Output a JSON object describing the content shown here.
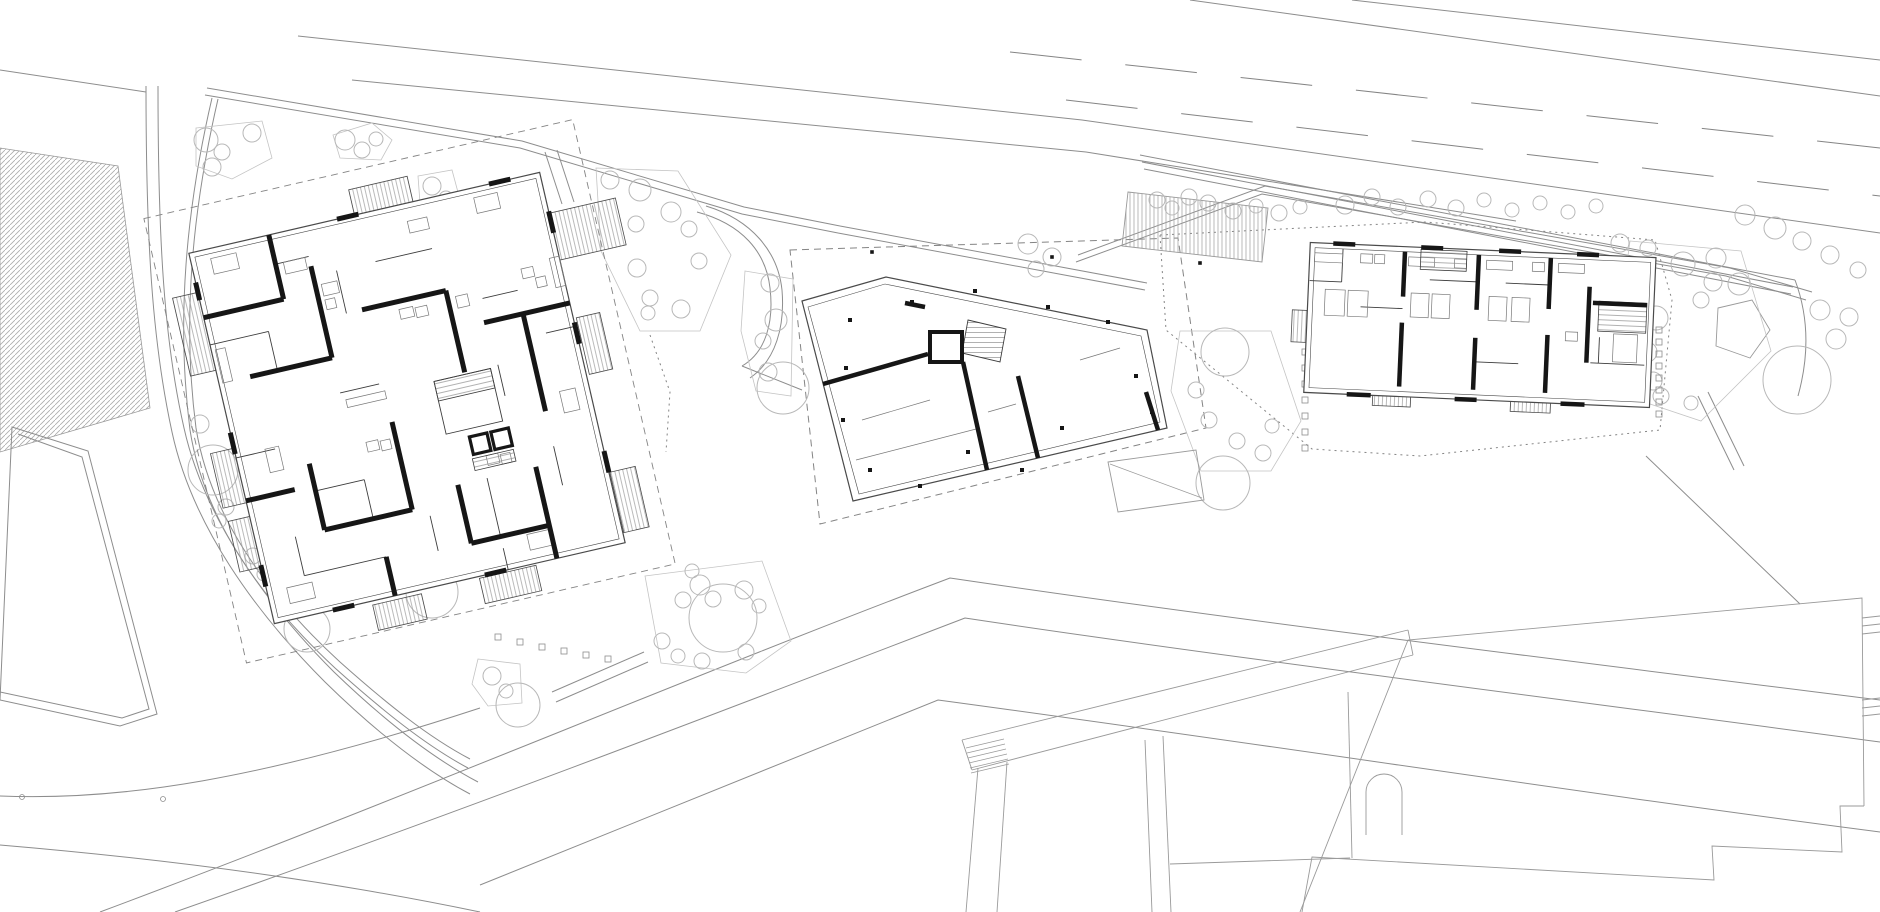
{
  "meta": {
    "type": "architectural-site-plan",
    "canvas": {
      "w": 1880,
      "h": 912
    }
  },
  "palette": {
    "bg": "#ffffff",
    "ink": "#161616",
    "wall_thin": "#3c3c3c",
    "outline": "#4a4a4a",
    "context": "#8d8d8d",
    "faint": "#9a9a9a",
    "tree": "#b8b8b8",
    "cluster": "#c4c4c4",
    "furniture": "#787878",
    "dash": "#848484",
    "hatch": "#a6a6a6"
  },
  "context": {
    "hatch_field": "0,148 118,166 150,408 0,452",
    "lines": [
      "M0,70 L146,92",
      "M298,36 L1082,120 L1880,233",
      "M352,80 L1086,152 L1516,221",
      "M1190,0 L1880,96",
      "M1352,0 L1880,60",
      "M146,86 C146,240 152,340 172,432 C192,525 255,612 325,682 C378,734 428,772 470,794",
      "M158,86 C158,240 164,340 184,428 C204,518 266,604 334,672 C388,724 436,760 478,782",
      "M212,98 C186,210 176,320 190,430 C204,520 262,600 335,668 C382,710 425,745 468,768",
      "M218,99 C192,212 182,320 196,428 C210,516 268,596 340,662 C386,703 428,737 470,759",
      "M100,912 C400,800 680,680 950,578 C1220,618 1560,660 1880,700",
      "M175,912 C460,812 720,712 965,618 C1230,658 1570,700 1880,742",
      "M480,885 C700,795 850,735 938,700 C1250,742 1600,796 1880,832",
      "M0,796 C120,801 260,780 480,708",
      "M0,845 C200,862 350,885 480,912",
      "M556,702 L648,662",
      "M552,692 L644,652",
      "M205,95 L520,148 L742,214 L838,233",
      "M207,88 L522,141 L744,207 L840,226",
      "M840,226 L1147,283",
      "M838,233 L1145,290",
      "M1078,255 L1265,186 L1730,268 L1812,292",
      "M1076,262 L1262,194 L1726,276 L1806,300",
      "M1140,155 L1795,280",
      "M1142,162 L1793,287",
      "M1144,169 L1791,294",
      "M1795,280 C1810,320 1808,360 1798,396",
      "M545,152 L562,204",
      "M557,150 L574,202",
      "M697,212 C742,224 766,252 770,288 C774,322 766,352 742,366",
      "M706,206 C752,220 778,252 782,290 C785,326 776,360 750,378",
      "M742,366 L802,390",
      "M1698,396 L1734,470",
      "M1708,392 L1744,466",
      "M1646,456 L1800,604"
    ],
    "dashed_lines": [
      {
        "d": "M1010,52 L1880,148",
        "dash": "72 44"
      },
      {
        "d": "M1066,100 L1880,196",
        "dash": "72 44"
      },
      {
        "d": "M790,250 L1178,238 L1206,428 L820,524 Z",
        "dash": "7 5"
      },
      {
        "d": "M1160,235 L1425,222 L1655,240 L1672,300 L1660,430 L1420,456 L1312,449 L1166,330 Z",
        "dash": "2 4"
      },
      {
        "d": "M650,335 L670,392 L666,452",
        "dash": "2 4"
      }
    ],
    "parcel": [
      "M12,427 L88,451 L157,714 L120,726 L0,700 Z",
      "M18,434 L82,457 L149,709 L122,718 L0,692"
    ],
    "pentagon": "1718,308 1752,300 1770,330 1750,358 1716,346",
    "terrace_deck": "1128,192 1268,208 1262,262 1122,246",
    "survey_points": [
      [
        22,
        797
      ],
      [
        163,
        799
      ]
    ],
    "walk_dots": [
      [
        455,
        222
      ],
      [
        530,
        224
      ],
      [
        872,
        252
      ],
      [
        1052,
        257
      ],
      [
        1200,
        263
      ]
    ]
  },
  "south_buildings": {
    "lines": [
      "M962,740 L1408,630",
      "M972,770 L1413,655",
      "M962,740 L972,770",
      "M1408,630 L1413,655",
      "M978,768 L966,912",
      "M1007,762 L997,912",
      "M1145,740 L1152,912",
      "M1163,736 L1171,912",
      "M1348,692 L1352,858",
      "M1170,864 L1350,858",
      "M1864,806 L1862,598 L1408,640 L1300,912",
      "M1864,806 L1840,806 L1842,852 L1712,846 L1714,880 L1312,857 L1302,912",
      "M1862,618 L1880,616",
      "M1862,626 L1880,624",
      "M1862,634 L1880,632",
      "M1862,700 L1880,698",
      "M1862,708 L1880,706",
      "M1862,716 L1880,714"
    ],
    "steps": [
      "M966,748 L1004,739",
      "M967,753 L1005,744",
      "M968,758 L1006,749",
      "M969,763 L1007,754",
      "M970,768 L1008,759",
      "M971,773 L1009,764"
    ],
    "arch": "M1366,835 L1366,792 A18,18 0 0 1 1402,792 L1402,835"
  },
  "tree_clusters": [
    "196,128 262,121 272,158 232,179 196,166",
    "333,135 372,123 392,140 381,160 340,158",
    "418,176 452,170 459,196 441,211 420,203",
    "500,189 540,184 546,231 531,268 505,256",
    "596,168 678,171 731,255 700,331 640,331 601,251",
    "745,271 793,279 791,396 756,391 741,331",
    "645,576 762,561 791,641 746,673 661,663",
    "1180,331 1271,331 1301,421 1271,471 1201,471 1171,391",
    "1630,241 1741,251 1771,351 1701,421 1641,401 1619,321",
    "478,659 520,664 522,703 488,706 472,684"
  ],
  "trees": [
    [
      206,
      140,
      12
    ],
    [
      222,
      152,
      8
    ],
    [
      212,
      167,
      9
    ],
    [
      252,
      133,
      9
    ],
    [
      345,
      140,
      10
    ],
    [
      362,
      150,
      8
    ],
    [
      376,
      139,
      7
    ],
    [
      432,
      186,
      9
    ],
    [
      446,
      198,
      7
    ],
    [
      517,
      196,
      10
    ],
    [
      507,
      224,
      8
    ],
    [
      519,
      245,
      8
    ],
    [
      532,
      261,
      7
    ],
    [
      610,
      180,
      9
    ],
    [
      640,
      190,
      11
    ],
    [
      671,
      212,
      10
    ],
    [
      636,
      224,
      8
    ],
    [
      689,
      229,
      8
    ],
    [
      637,
      268,
      9
    ],
    [
      650,
      298,
      8
    ],
    [
      699,
      261,
      8
    ],
    [
      681,
      309,
      9
    ],
    [
      648,
      313,
      7
    ],
    [
      1028,
      244,
      10
    ],
    [
      1052,
      257,
      9
    ],
    [
      1036,
      269,
      8
    ],
    [
      770,
      283,
      9
    ],
    [
      776,
      320,
      11
    ],
    [
      763,
      341,
      8
    ],
    [
      768,
      372,
      9
    ],
    [
      783,
      388,
      26
    ],
    [
      213,
      470,
      25
    ],
    [
      200,
      424,
      9
    ],
    [
      226,
      507,
      8
    ],
    [
      219,
      521,
      7
    ],
    [
      253,
      556,
      8
    ],
    [
      264,
      574,
      7
    ],
    [
      307,
      629,
      23
    ],
    [
      432,
      592,
      26
    ],
    [
      492,
      676,
      9
    ],
    [
      506,
      691,
      7
    ],
    [
      518,
      705,
      22
    ],
    [
      700,
      585,
      10
    ],
    [
      683,
      600,
      8
    ],
    [
      713,
      599,
      8
    ],
    [
      744,
      590,
      9
    ],
    [
      759,
      606,
      7
    ],
    [
      692,
      571,
      7
    ],
    [
      662,
      641,
      8
    ],
    [
      678,
      656,
      7
    ],
    [
      702,
      661,
      8
    ],
    [
      746,
      652,
      8
    ],
    [
      723,
      618,
      34
    ],
    [
      1196,
      390,
      8
    ],
    [
      1209,
      420,
      8
    ],
    [
      1237,
      441,
      8
    ],
    [
      1263,
      453,
      8
    ],
    [
      1272,
      426,
      7
    ],
    [
      1225,
      352,
      24
    ],
    [
      1223,
      483,
      27
    ],
    [
      1157,
      200,
      8
    ],
    [
      1172,
      208,
      7
    ],
    [
      1189,
      197,
      8
    ],
    [
      1208,
      203,
      8
    ],
    [
      1233,
      211,
      8
    ],
    [
      1256,
      206,
      7
    ],
    [
      1279,
      213,
      8
    ],
    [
      1300,
      207,
      7
    ],
    [
      1345,
      205,
      9
    ],
    [
      1372,
      197,
      8
    ],
    [
      1398,
      207,
      8
    ],
    [
      1428,
      199,
      8
    ],
    [
      1456,
      208,
      8
    ],
    [
      1484,
      200,
      7
    ],
    [
      1512,
      210,
      7
    ],
    [
      1540,
      203,
      7
    ],
    [
      1568,
      212,
      7
    ],
    [
      1596,
      206,
      7
    ],
    [
      1620,
      243,
      9
    ],
    [
      1648,
      248,
      8
    ],
    [
      1683,
      264,
      12
    ],
    [
      1716,
      258,
      10
    ],
    [
      1739,
      284,
      11
    ],
    [
      1701,
      300,
      8
    ],
    [
      1656,
      318,
      12
    ],
    [
      1641,
      338,
      10
    ],
    [
      1713,
      282,
      9
    ],
    [
      1647,
      352,
      10
    ],
    [
      1653,
      381,
      9
    ],
    [
      1661,
      396,
      8
    ],
    [
      1691,
      403,
      7
    ],
    [
      1797,
      380,
      34
    ],
    [
      1820,
      310,
      10
    ],
    [
      1849,
      317,
      9
    ],
    [
      1836,
      339,
      10
    ],
    [
      1745,
      215,
      10
    ],
    [
      1775,
      228,
      11
    ],
    [
      1802,
      241,
      9
    ],
    [
      1830,
      255,
      9
    ],
    [
      1858,
      270,
      8
    ]
  ],
  "bollards": [
    [
      498,
      637
    ],
    [
      520,
      642
    ],
    [
      542,
      647
    ],
    [
      564,
      651
    ],
    [
      586,
      655
    ],
    [
      608,
      659
    ],
    [
      1305,
      352
    ],
    [
      1305,
      368
    ],
    [
      1305,
      384
    ],
    [
      1305,
      400
    ],
    [
      1305,
      416
    ],
    [
      1305,
      432
    ],
    [
      1305,
      448
    ],
    [
      1659,
      330
    ],
    [
      1659,
      342
    ],
    [
      1659,
      354
    ],
    [
      1659,
      366
    ],
    [
      1659,
      378
    ],
    [
      1659,
      390
    ],
    [
      1659,
      402
    ],
    [
      1659,
      414
    ]
  ],
  "buildings": {
    "a": {
      "transform": "translate(407,398) rotate(-13)",
      "plot_dash": [
        -216,
        -234,
        440,
        456
      ],
      "outline": [
        -180,
        -190,
        360,
        380
      ],
      "inner": [
        -175,
        -185,
        350,
        370
      ],
      "balconies": [
        [
          -206,
          -150,
          26,
          80
        ],
        [
          -10,
          -216,
          60,
          26
        ],
        [
          172,
          -148,
          76,
          48
        ],
        [
          183,
          -40,
          24,
          58
        ],
        [
          181,
          118,
          26,
          62
        ],
        [
          30,
          192,
          58,
          26
        ],
        [
          -80,
          194,
          50,
          26
        ],
        [
          -204,
          10,
          26,
          56
        ],
        [
          -202,
          80,
          24,
          52
        ]
      ],
      "thick": [
        "M-180,-124 L-98,-124",
        "M-98,-190 L-98,-124",
        "M-64,-150 L-64,-56",
        "M-148,-56 L-64,-56",
        "M-24,-96 L62,-96",
        "M62,-96 L62,-12",
        "M92,-56 L180,-56",
        "M132,-56 L132,44",
        "M-20,20 L-20,110",
        "M-110,42 L-110,110",
        "M-110,110 L-20,110",
        "M-56,150 L-56,190",
        "M30,96 L30,156",
        "M30,156 L110,156",
        "M110,96 L110,190",
        "M-180,64 L-130,64",
        "M-180,-160 L-180,-142",
        "M-28,-190 L-6,-190",
        "M128,-190 L150,-190",
        "M180,-150 L180,-128",
        "M180,-36 L180,-14",
        "M180,96 L180,118",
        "M36,190 L58,190",
        "M-120,190 L-98,190",
        "M-180,130 L-180,152",
        "M-180,-6 L-180,16"
      ],
      "thin": [
        "M-180,-96 L-120,-96",
        "M-120,-96 L-120,-56",
        "M-40,-140 L-40,-96",
        "M0,-140 L58,-140",
        "M96,-80 L132,-80",
        "M150,-32 L180,-32",
        "M-110,70 L-60,70",
        "M-60,70 L-60,110",
        "M-4,120 L-4,156",
        "M60,96 L60,156",
        "M-140,110 L-140,150",
        "M-140,150 L-56,150",
        "M60,168 L60,190",
        "M132,80 L132,120",
        "M-64,-20 L-24,-20",
        "M-180,20 L-140,20",
        "M96,-12 L96,20",
        "M-98,-160 L-64,-160"
      ],
      "court": [
        30,
        -10,
        58,
        54
      ],
      "stair_hatch": [
        [
          30,
          -10,
          58,
          20
        ],
        [
          50,
          74,
          42,
          12
        ]
      ],
      "elevators": [
        [
          52,
          52,
          18,
          18
        ],
        [
          74,
          52,
          18,
          18
        ]
      ],
      "furniture": [
        [
          -58,
          -130,
          16,
          12
        ],
        [
          -58,
          -114,
          10,
          10
        ],
        [
          12,
          -88,
          14,
          10
        ],
        [
          28,
          -86,
          12,
          10
        ],
        [
          70,
          -88,
          12,
          12
        ],
        [
          -50,
          34,
          12,
          10
        ],
        [
          -36,
          36,
          10,
          10
        ],
        [
          64,
          74,
          12,
          10
        ],
        [
          78,
          76,
          10,
          10
        ],
        [
          140,
          -100,
          12,
          10
        ],
        [
          152,
          -88,
          10,
          10
        ],
        [
          -176,
          -90,
          10,
          34
        ],
        [
          170,
          -104,
          10,
          30
        ],
        [
          -160,
          -180,
          26,
          16
        ],
        [
          110,
          -180,
          24,
          16
        ],
        [
          -160,
          158,
          26,
          16
        ],
        [
          86,
          160,
          24,
          16
        ],
        [
          -90,
          -160,
          22,
          12
        ],
        [
          40,
          -172,
          20,
          12
        ],
        [
          150,
          28,
          16,
          22
        ],
        [
          -150,
          18,
          14,
          24
        ],
        [
          -60,
          -12,
          40,
          8
        ]
      ]
    },
    "b": {
      "outline": "802,301 886,277 1147,330 1167,428 853,501",
      "inner": "808,307 885,284 1141,336 1160,422 859,494",
      "thick": [
        "M823,384 L928,354",
        "M963,362 L987,470",
        "M1018,376 L1038,458",
        "M905,303 L925,307",
        "M1146,392 L1158,430"
      ],
      "square_room": "M930,332 L962,332 L962,362 L930,362 Z",
      "stair": "968,320 1006,329 1000,362 962,353",
      "thin": [
        "M862,420 L930,400",
        "M1080,360 L1120,348",
        "M988,412 L1016,404",
        "M856,460 L980,428"
      ],
      "dots": [
        [
          850,
          320
        ],
        [
          912,
          302
        ],
        [
          975,
          291
        ],
        [
          1048,
          307
        ],
        [
          1108,
          322
        ],
        [
          1136,
          376
        ],
        [
          1152,
          412
        ],
        [
          846,
          368
        ],
        [
          843,
          420
        ],
        [
          870,
          470
        ],
        [
          920,
          486
        ],
        [
          968,
          452
        ],
        [
          1022,
          470
        ],
        [
          1062,
          428
        ]
      ],
      "annex": "1108,462 1196,450 1204,500 1118,512",
      "annex_line": "M1110,464 L1202,498"
    },
    "c": {
      "transform": "translate(1480,322) rotate(2.5)",
      "outline": [
        -173,
        -72,
        346,
        150
      ],
      "inner": [
        -168,
        -67,
        336,
        140
      ],
      "balconies": [
        [
          -188,
          -4,
          28,
          32
        ],
        [
          -104,
          40,
          38,
          48
        ],
        [
          34,
          36,
          40,
          52
        ]
      ],
      "thick": [
        "M-78,-67 L-78,-22",
        "M-78,4 L-78,68",
        "M-4,-67 L-4,-12",
        "M-4,16 L-4,68",
        "M68,-67 L68,-16",
        "M68,10 L68,68",
        "M108,-40 L108,36",
        "M112,-24 L166,-24",
        "M-150,-72 L-128,-72",
        "M-62,-72 L-40,-72",
        "M16,-72 L38,-72",
        "M94,-72 L116,-72",
        "M-130,78 L-106,78",
        "M-22,78 L0,78",
        "M84,78 L108,78"
      ],
      "thin": [
        "M-172,-34 L-140,-34",
        "M-140,-67 L-140,-34",
        "M-120,-10 L-78,-10",
        "M-52,-40 L-4,-40",
        "M24,-40 L68,-40",
        "M-4,40 L40,40",
        "M112,36 L166,36",
        "M120,10 L120,36"
      ],
      "stair_hatch": [
        [
          -62,
          -70,
          46,
          20
        ],
        [
          118,
          -26,
          48,
          30
        ]
      ],
      "furniture": [
        [
          -168,
          -62,
          28,
          9
        ],
        [
          -122,
          -63,
          12,
          9
        ],
        [
          -108,
          -63,
          10,
          9
        ],
        [
          -156,
          -26,
          20,
          26
        ],
        [
          -133,
          -26,
          20,
          26
        ],
        [
          -74,
          -62,
          26,
          9
        ],
        [
          -70,
          -26,
          18,
          24
        ],
        [
          -49,
          -26,
          18,
          24
        ],
        [
          -28,
          -62,
          12,
          9
        ],
        [
          4,
          -62,
          26,
          9
        ],
        [
          8,
          -26,
          18,
          24
        ],
        [
          31,
          -26,
          18,
          24
        ],
        [
          50,
          -62,
          12,
          9
        ],
        [
          76,
          -62,
          26,
          9
        ],
        [
          86,
          6,
          12,
          9
        ],
        [
          134,
          6,
          24,
          28
        ]
      ]
    }
  }
}
